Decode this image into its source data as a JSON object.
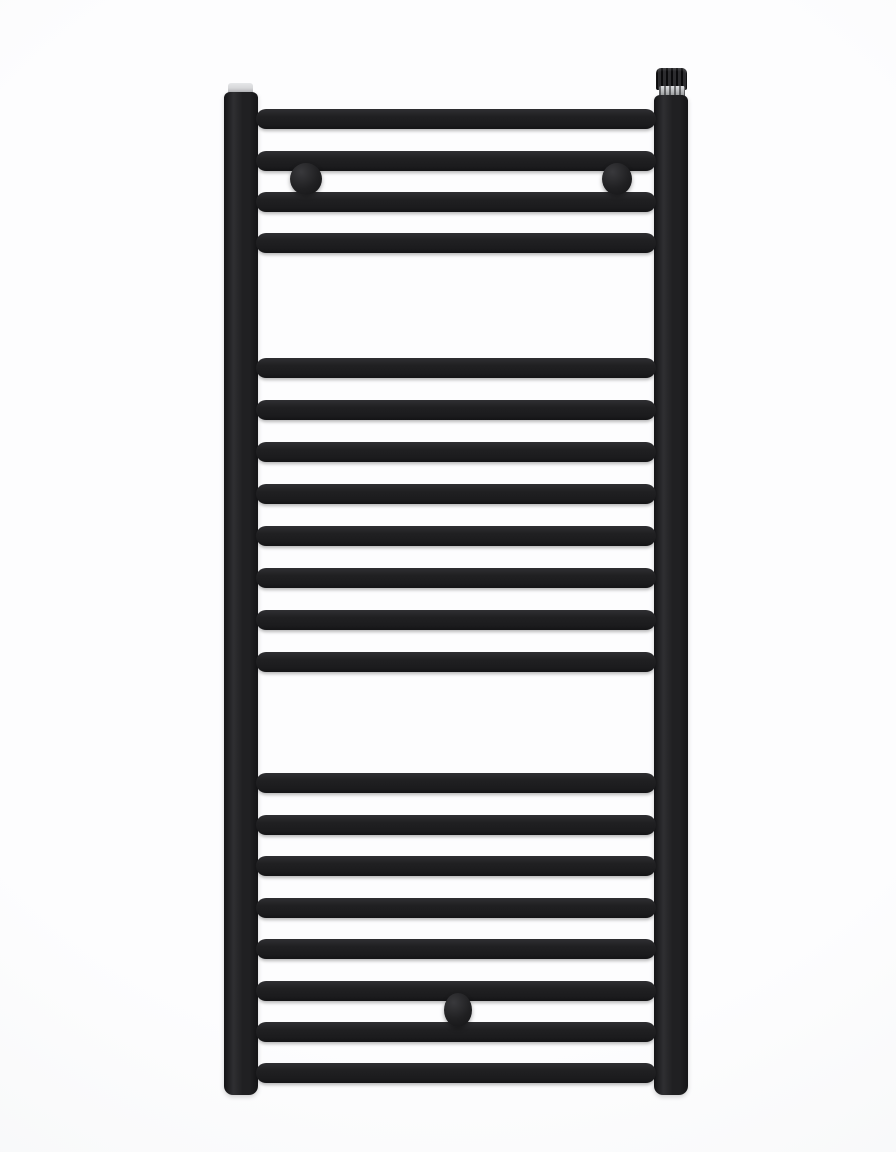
{
  "scene": {
    "subject": "black flat ladder-style heated towel rail radiator, front view product photo",
    "background_color": "#fdfdfe",
    "background_edge_color": "#f3f4f5"
  },
  "radiator": {
    "colors": {
      "base": "#202022",
      "shadow": "#141416",
      "highlight": "#2f2f32",
      "chrome": "#b6b8ba",
      "chrome_highlight": "#dcdde0",
      "plug": "#d6d7d9"
    },
    "rails": {
      "left": {
        "x": 224,
        "y": 92,
        "width": 34,
        "height": 1003
      },
      "right": {
        "x": 654,
        "y": 95,
        "width": 34,
        "height": 1000
      }
    },
    "bars": {
      "x": 256,
      "width": 400,
      "height": 20,
      "groups": [
        {
          "name": "top",
          "tops": [
            109,
            151,
            192,
            233
          ]
        },
        {
          "name": "middle",
          "tops": [
            358,
            400,
            442,
            484,
            526,
            568,
            610,
            652
          ]
        },
        {
          "name": "bottom",
          "tops": [
            773,
            815,
            856,
            898,
            939,
            981,
            1022,
            1063
          ]
        }
      ]
    },
    "fittings": {
      "air_vent_valve": {
        "cap": {
          "x": 656,
          "y": 68,
          "width": 31,
          "height": 22
        },
        "collar": {
          "x": 659,
          "y": 86,
          "width": 26,
          "height": 12
        }
      },
      "top_plug": {
        "x": 228,
        "y": 83,
        "width": 25,
        "height": 10
      },
      "wall_brackets": [
        {
          "cx": 306,
          "cy": 179,
          "rx": 16,
          "ry": 16
        },
        {
          "cx": 617,
          "cy": 179,
          "rx": 15,
          "ry": 16
        }
      ],
      "bottom_knob": {
        "cx": 458,
        "cy": 1010,
        "rx": 14,
        "ry": 17
      }
    }
  }
}
